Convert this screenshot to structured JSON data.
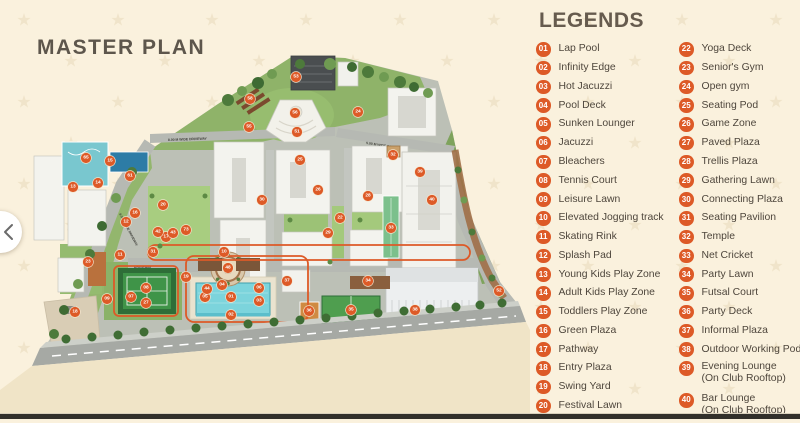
{
  "colors": {
    "background": "#FAF1DD",
    "accent": "#DD5A27",
    "heading": "#5D564C",
    "legend_text": "#4E463C",
    "pool_blue": "#7CD4DC",
    "court_green": "#3F9448",
    "road_gray": "#B6B9B3"
  },
  "master_plan": {
    "title": "MASTER PLAN",
    "nav": {
      "prev_arrow": "‹"
    },
    "driveways": {
      "top_left": "8.00 M WIDE DRIVEWAY",
      "top_right": "5.00 M WIDE DRIVEWAY",
      "left": "8.00 M WIDE DRIVEWAY",
      "center": "DRIVEWAY"
    },
    "markers": [
      {
        "n": "01",
        "x": 231,
        "y": 297
      },
      {
        "n": "02",
        "x": 231,
        "y": 315
      },
      {
        "n": "03",
        "x": 259,
        "y": 301
      },
      {
        "n": "04",
        "x": 222,
        "y": 285
      },
      {
        "n": "05",
        "x": 205,
        "y": 297
      },
      {
        "n": "06",
        "x": 259,
        "y": 288
      },
      {
        "n": "07",
        "x": 131,
        "y": 297
      },
      {
        "n": "08",
        "x": 146,
        "y": 288
      },
      {
        "n": "09",
        "x": 107,
        "y": 299
      },
      {
        "n": "10",
        "x": 224,
        "y": 252
      },
      {
        "n": "11",
        "x": 120,
        "y": 255
      },
      {
        "n": "12",
        "x": 126,
        "y": 222
      },
      {
        "n": "13",
        "x": 73,
        "y": 187
      },
      {
        "n": "14",
        "x": 98,
        "y": 183
      },
      {
        "n": "15",
        "x": 110,
        "y": 161
      },
      {
        "n": "16",
        "x": 135,
        "y": 213
      },
      {
        "n": "17",
        "x": 166,
        "y": 237
      },
      {
        "n": "18",
        "x": 75,
        "y": 312
      },
      {
        "n": "19",
        "x": 186,
        "y": 277
      },
      {
        "n": "20",
        "x": 163,
        "y": 205
      },
      {
        "n": "22",
        "x": 340,
        "y": 218
      },
      {
        "n": "23",
        "x": 88,
        "y": 262
      },
      {
        "n": "24",
        "x": 358,
        "y": 112
      },
      {
        "n": "25",
        "x": 300,
        "y": 160
      },
      {
        "n": "26",
        "x": 318,
        "y": 190
      },
      {
        "n": "27",
        "x": 146,
        "y": 303
      },
      {
        "n": "28",
        "x": 368,
        "y": 196
      },
      {
        "n": "29",
        "x": 328,
        "y": 233
      },
      {
        "n": "30",
        "x": 262,
        "y": 200
      },
      {
        "n": "31",
        "x": 153,
        "y": 252
      },
      {
        "n": "32",
        "x": 393,
        "y": 155
      },
      {
        "n": "33",
        "x": 391,
        "y": 228
      },
      {
        "n": "34",
        "x": 368,
        "y": 281
      },
      {
        "n": "35",
        "x": 351,
        "y": 310
      },
      {
        "n": "36",
        "x": 309,
        "y": 311
      },
      {
        "n": "37",
        "x": 287,
        "y": 281
      },
      {
        "n": "38",
        "x": 415,
        "y": 310
      },
      {
        "n": "39",
        "x": 420,
        "y": 172
      },
      {
        "n": "40",
        "x": 432,
        "y": 200
      },
      {
        "n": "42",
        "x": 158,
        "y": 232
      },
      {
        "n": "43",
        "x": 173,
        "y": 233
      },
      {
        "n": "44",
        "x": 207,
        "y": 289
      },
      {
        "n": "48",
        "x": 228,
        "y": 268
      },
      {
        "n": "51",
        "x": 297,
        "y": 132
      },
      {
        "n": "52",
        "x": 499,
        "y": 291
      },
      {
        "n": "53",
        "x": 296,
        "y": 77
      },
      {
        "n": "55",
        "x": 249,
        "y": 127
      },
      {
        "n": "56",
        "x": 295,
        "y": 113
      },
      {
        "n": "58",
        "x": 250,
        "y": 99
      },
      {
        "n": "61",
        "x": 130,
        "y": 176
      },
      {
        "n": "65",
        "x": 86,
        "y": 158
      },
      {
        "n": "73",
        "x": 186,
        "y": 230
      }
    ]
  },
  "legends": {
    "title": "LEGENDS",
    "column1": [
      {
        "num": "01",
        "label": "Lap Pool"
      },
      {
        "num": "02",
        "label": "Infinity Edge"
      },
      {
        "num": "03",
        "label": "Hot Jacuzzi"
      },
      {
        "num": "04",
        "label": "Pool Deck"
      },
      {
        "num": "05",
        "label": "Sunken Lounger"
      },
      {
        "num": "06",
        "label": "Jacuzzi"
      },
      {
        "num": "07",
        "label": "Bleachers"
      },
      {
        "num": "08",
        "label": "Tennis Court"
      },
      {
        "num": "09",
        "label": "Leisure Lawn"
      },
      {
        "num": "10",
        "label": "Elevated Jogging track"
      },
      {
        "num": "11",
        "label": "Skating Rink"
      },
      {
        "num": "12",
        "label": "Splash Pad"
      },
      {
        "num": "13",
        "label": "Young Kids Play Zone"
      },
      {
        "num": "14",
        "label": "Adult Kids Play Zone"
      },
      {
        "num": "15",
        "label": "Toddlers Play Zone"
      },
      {
        "num": "16",
        "label": "Green Plaza"
      },
      {
        "num": "17",
        "label": "Pathway"
      },
      {
        "num": "18",
        "label": "Entry Plaza"
      },
      {
        "num": "19",
        "label": "Swing Yard"
      },
      {
        "num": "20",
        "label": "Festival Lawn"
      }
    ],
    "column2": [
      {
        "num": "22",
        "label": "Yoga Deck"
      },
      {
        "num": "23",
        "label": "Senior's Gym"
      },
      {
        "num": "24",
        "label": "Open gym"
      },
      {
        "num": "25",
        "label": "Seating Pod"
      },
      {
        "num": "26",
        "label": "Game Zone"
      },
      {
        "num": "27",
        "label": "Paved Plaza"
      },
      {
        "num": "28",
        "label": "Trellis Plaza"
      },
      {
        "num": "29",
        "label": "Gathering Lawn"
      },
      {
        "num": "30",
        "label": "Connecting Plaza"
      },
      {
        "num": "31",
        "label": "Seating Pavilion"
      },
      {
        "num": "32",
        "label": "Temple"
      },
      {
        "num": "33",
        "label": "Net Cricket"
      },
      {
        "num": "34",
        "label": "Party Lawn"
      },
      {
        "num": "35",
        "label": "Futsal Court"
      },
      {
        "num": "36",
        "label": "Party Deck"
      },
      {
        "num": "37",
        "label": "Informal Plaza"
      },
      {
        "num": "38",
        "label": "Outdoor Working Pods"
      },
      {
        "num": "39",
        "label": "Evening Lounge",
        "sub": "(On Club Rooftop)"
      },
      {
        "num": "40",
        "label": "Bar Lounge",
        "sub": "(On Club Rooftop)"
      }
    ]
  }
}
